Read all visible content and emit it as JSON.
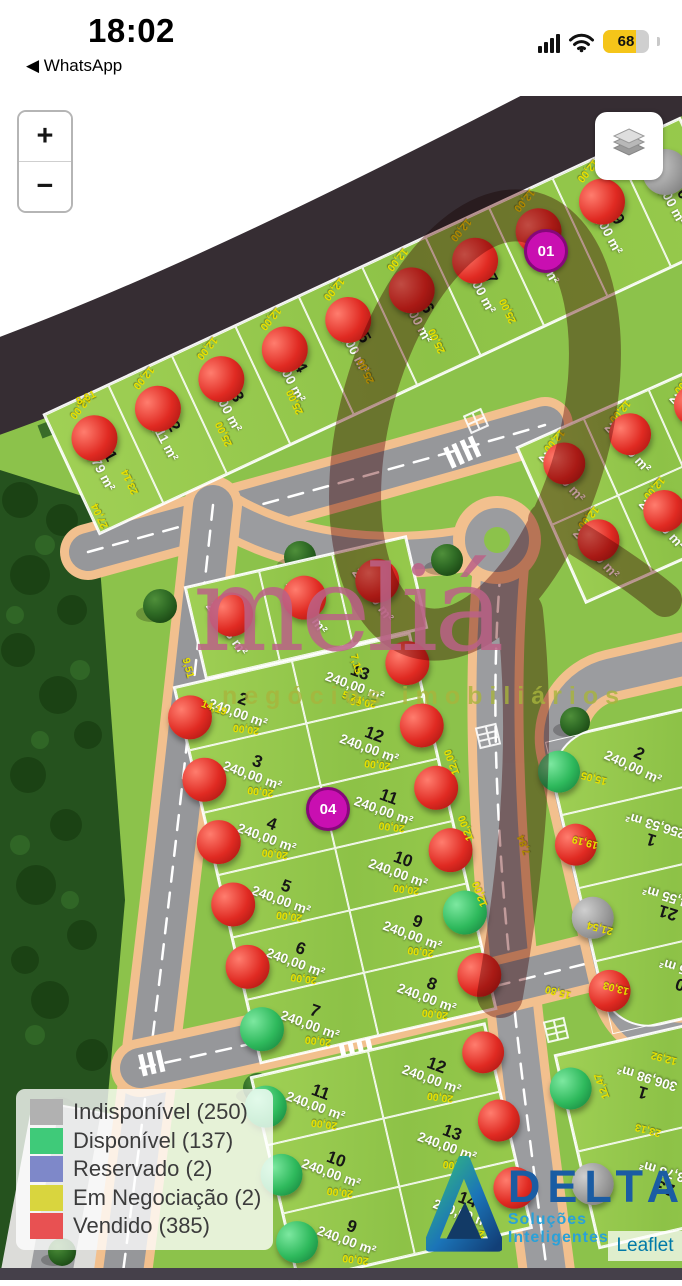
{
  "status_bar": {
    "time": "18:02",
    "back_link": "◀ WhatsApp",
    "battery_percent": "68",
    "battery_color": "#f5c519"
  },
  "controls": {
    "zoom_in": "+",
    "zoom_out": "−"
  },
  "legend": {
    "items": [
      {
        "label": "Indisponível (250)",
        "color": "#b1b1b1"
      },
      {
        "label": "Disponível (137)",
        "color": "#3fca79"
      },
      {
        "label": "Reservado (2)",
        "color": "#7e88c9"
      },
      {
        "label": "Em Negociação (2)",
        "color": "#d9d53e"
      },
      {
        "label": "Vendido (385)",
        "color": "#e85152"
      }
    ]
  },
  "watermark": {
    "brand": "meliá",
    "tagline": "negócios imobiliários"
  },
  "vendor": {
    "name": "DELTA",
    "tagline": "Soluções Inteligentes"
  },
  "attribution": {
    "label": "Leaflet"
  },
  "map": {
    "marker_colors": {
      "vendido": {
        "hi": "#ff7d6e",
        "mid": "#e02a22",
        "lo": "#9c120e"
      },
      "disponivel": {
        "hi": "#7de8a0",
        "mid": "#2eb95c",
        "lo": "#127a38"
      },
      "indisponivel": {
        "hi": "#cfcfcf",
        "mid": "#9b9b9b",
        "lo": "#6f6f6f"
      }
    },
    "badges": [
      {
        "label": "01",
        "x": 543,
        "y": 248
      },
      {
        "label": "04",
        "x": 325,
        "y": 806
      }
    ],
    "blocks": [
      {
        "name": "quadra-top",
        "x": 45,
        "y": 415,
        "w": 700,
        "h": 130,
        "rot": -25,
        "innerRot": 87,
        "side": "top",
        "msize": 46,
        "cellDim": {
          "text": "12,00",
          "pos": "top",
          "rot": 155
        },
        "rows": [
          [
            {
              "n": "1",
              "area": "244,79 m²",
              "m": "vendido"
            },
            {
              "n": "2",
              "area": "300,11 m²",
              "m": "vendido"
            },
            {
              "n": "3",
              "area": "300,00 m²",
              "m": "vendido"
            },
            {
              "n": "4",
              "area": "300,00 m²",
              "m": "vendido"
            },
            {
              "n": "5",
              "area": "300,00 m²",
              "m": "vendido"
            },
            {
              "n": "6",
              "area": "300,00 m²",
              "m": "vendido"
            },
            {
              "n": "7",
              "area": "300,00 m²",
              "m": "vendido"
            },
            {
              "n": "8",
              "area": "300,00 m²",
              "m": "vendido"
            },
            {
              "n": "9",
              "area": "300,00 m²",
              "m": "vendido"
            },
            {
              "n": "10",
              "area": "300,00 m²",
              "m": "indisponivel"
            }
          ]
        ]
      },
      {
        "name": "quadra-mid-top",
        "x": 186,
        "y": 588,
        "w": 225,
        "h": 92,
        "rot": -13,
        "innerRot": 68,
        "side": "top",
        "msize": 44,
        "rows": [
          [
            {
              "n": "1",
              "area": "240,73 m²",
              "m": "vendido"
            },
            {
              "n": "",
              "area": "268,23 m²",
              "m": "vendido"
            },
            {
              "n": "14",
              "area": "272,00 m²",
              "m": "vendido"
            }
          ]
        ]
      },
      {
        "name": "quadra-mid",
        "x": 175,
        "y": 688,
        "w": 240,
        "h": 384,
        "rot": -13,
        "innerRot": 33,
        "msize": 44,
        "cellDim": {
          "text": "20,00",
          "pos": "bottom",
          "rot": 200
        },
        "rows": [
          [
            {
              "n": "2",
              "area": "240,00 m²",
              "m": "vendido",
              "side": "left"
            },
            {
              "n": "13",
              "area": "240,00 m²",
              "m": "vendido",
              "side": "right"
            }
          ],
          [
            {
              "n": "3",
              "area": "240,00 m²",
              "m": "vendido",
              "side": "left"
            },
            {
              "n": "12",
              "area": "240,00 m²",
              "m": "vendido",
              "side": "right"
            }
          ],
          [
            {
              "n": "4",
              "area": "240,00 m²",
              "m": "vendido",
              "side": "left"
            },
            {
              "n": "11",
              "area": "240,00 m²",
              "m": "vendido",
              "side": "right"
            }
          ],
          [
            {
              "n": "5",
              "area": "240,00 m²",
              "m": "vendido",
              "side": "left"
            },
            {
              "n": "10",
              "area": "240,00 m²",
              "m": "vendido",
              "side": "right"
            }
          ],
          [
            {
              "n": "6",
              "area": "240,00 m²",
              "m": "vendido",
              "side": "left"
            },
            {
              "n": "9",
              "area": "240,00 m²",
              "m": "disponivel",
              "side": "right"
            }
          ],
          [
            {
              "n": "7",
              "area": "240,00 m²",
              "m": "disponivel",
              "side": "left"
            },
            {
              "n": "8",
              "area": "240,00 m²",
              "m": "vendido",
              "side": "right"
            }
          ]
        ]
      },
      {
        "name": "quadra-bottom",
        "x": 252,
        "y": 1078,
        "w": 238,
        "h": 208,
        "rot": -13,
        "innerRot": 33,
        "msize": 42,
        "cellDim": {
          "text": "20,00",
          "pos": "bottom",
          "rot": 200
        },
        "rows": [
          [
            {
              "n": "11",
              "area": "240,00 m²",
              "m": "disponivel",
              "side": "left"
            },
            {
              "n": "12",
              "area": "240,00 m²",
              "m": "vendido",
              "side": "right"
            }
          ],
          [
            {
              "n": "10",
              "area": "240,00 m²",
              "m": "disponivel",
              "side": "left"
            },
            {
              "n": "13",
              "area": "240,00 m²",
              "m": "vendido",
              "side": "right"
            }
          ],
          [
            {
              "n": "9",
              "area": "240,00 m²",
              "m": "disponivel",
              "side": "left"
            },
            {
              "n": "14",
              "area": "240,00 m²",
              "m": "vendido",
              "side": "right"
            }
          ]
        ]
      },
      {
        "name": "quadra-right-top",
        "x": 518,
        "y": 448,
        "w": 215,
        "h": 168,
        "rot": -24,
        "innerRot": 72,
        "side": "top",
        "msize": 42,
        "cellDim": {
          "text": "12,00",
          "pos": "top",
          "rot": 155
        },
        "rows": [
          [
            {
              "n": "1",
              "area": "240,00 m²",
              "m": "vendido"
            },
            {
              "n": "2",
              "area": "240,00 m²",
              "m": "vendido"
            },
            {
              "n": "3",
              "area": "240,00 m²",
              "m": "vendido"
            }
          ],
          [
            {
              "n": "16",
              "area": "240,00 m²",
              "m": "vendido"
            },
            {
              "n": "15",
              "area": "240,00 m²",
              "m": "vendido"
            },
            {
              "n": "",
              "area": "",
              "m": null
            }
          ]
        ]
      },
      {
        "name": "quadra-right-mid",
        "x": 545,
        "y": 742,
        "w": 170,
        "h": 300,
        "rot": -13,
        "radius": "48px 0 0 48px",
        "msize": 42,
        "rows": [
          [
            {
              "n": "2",
              "area": "240,00 m²",
              "m": "disponivel",
              "side": "left",
              "rot": 38
            }
          ],
          [
            {
              "n": "1",
              "area": "256,53 m²",
              "m": "vendido",
              "side": "left",
              "rot": 210
            }
          ],
          [
            {
              "n": "21",
              "area": "254,55 m²",
              "m": "indisponivel",
              "side": "left",
              "rot": 210
            }
          ],
          [
            {
              "n": "20",
              "area": "256,15 m²",
              "m": "vendido",
              "side": "left",
              "rot": 210
            }
          ]
        ]
      },
      {
        "name": "quadra-bottom-right",
        "x": 556,
        "y": 1056,
        "w": 160,
        "h": 196,
        "rot": -13,
        "msize": 42,
        "rows": [
          [
            {
              "n": "1",
              "area": "306,98 m²",
              "m": "disponivel",
              "side": "left",
              "rot": 210
            }
          ],
          [
            {
              "n": "23",
              "area": "303,78 m²",
              "m": "indisponivel",
              "side": "left",
              "rot": 210
            }
          ]
        ]
      }
    ],
    "dims": [
      {
        "t": "8,81",
        "x": 86,
        "y": 398,
        "r": -25
      },
      {
        "t": "27,04",
        "x": 100,
        "y": 516,
        "r": -115
      },
      {
        "t": "23,14",
        "x": 130,
        "y": 482,
        "r": -115
      },
      {
        "t": "25,00",
        "x": 224,
        "y": 434,
        "r": -115
      },
      {
        "t": "25,00",
        "x": 295,
        "y": 402,
        "r": -115
      },
      {
        "t": "25,00",
        "x": 366,
        "y": 371,
        "r": -115
      },
      {
        "t": "25,00",
        "x": 437,
        "y": 341,
        "r": -115
      },
      {
        "t": "25,00",
        "x": 508,
        "y": 311,
        "r": -115
      },
      {
        "t": "9,51",
        "x": 188,
        "y": 668,
        "r": 75
      },
      {
        "t": "14,19",
        "x": 214,
        "y": 708,
        "r": 20
      },
      {
        "t": "7,15",
        "x": 356,
        "y": 664,
        "r": 75
      },
      {
        "t": "5,71",
        "x": 352,
        "y": 698,
        "r": 20
      },
      {
        "t": "12,00",
        "x": 452,
        "y": 762,
        "r": 250
      },
      {
        "t": "12,00",
        "x": 466,
        "y": 828,
        "r": 250
      },
      {
        "t": "12,00",
        "x": 480,
        "y": 894,
        "r": 250
      },
      {
        "t": "15,05",
        "x": 594,
        "y": 778,
        "r": 195
      },
      {
        "t": "7,84",
        "x": 524,
        "y": 845,
        "r": 250
      },
      {
        "t": "19,19",
        "x": 585,
        "y": 842,
        "r": 195
      },
      {
        "t": "21,54",
        "x": 600,
        "y": 928,
        "r": 195
      },
      {
        "t": "15,80",
        "x": 558,
        "y": 992,
        "r": 195
      },
      {
        "t": "13,03",
        "x": 616,
        "y": 988,
        "r": 195
      },
      {
        "t": "12,92",
        "x": 664,
        "y": 1058,
        "r": 195
      },
      {
        "t": "12,47",
        "x": 602,
        "y": 1086,
        "r": 250
      },
      {
        "t": "23,13",
        "x": 648,
        "y": 1130,
        "r": 195
      }
    ]
  }
}
